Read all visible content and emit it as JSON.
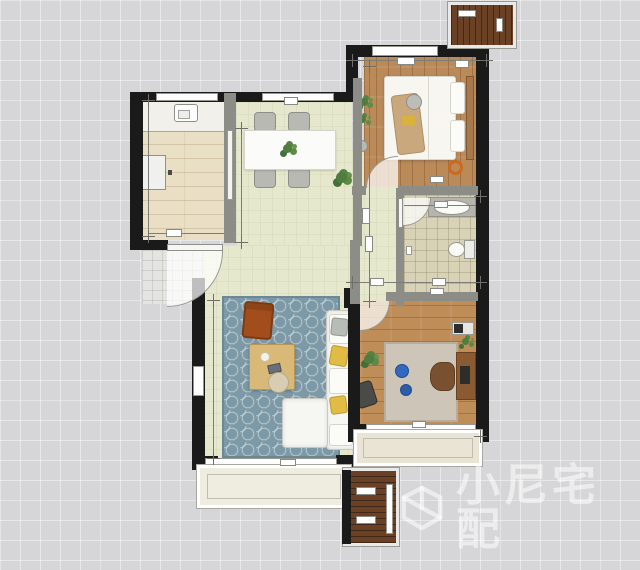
{
  "watermark": {
    "icon": "cube-logo-icon",
    "text": "小尼宅配"
  },
  "palette": {
    "background": "#d6d6d8",
    "grid_line": "#ffffff",
    "wall": "#1a1a1a",
    "partition_wall": "#8d8d88",
    "floor_green": "#e6e8cd",
    "floor_wood": "#bb8a59",
    "floor_kitchen_tile": "#e9dfc5",
    "floor_bath_tile": "#d8d2b7",
    "living_rug_blue": "#7d99a7",
    "bedroom_rug_gray": "#cdc5b7",
    "sofa_white": "#f6f6f3",
    "armchair_orange": "#a14e1c",
    "pillow_yellow": "#e0bc45",
    "coffee_table_wood": "#d9b977",
    "ac_platform_wood": "#6b4126",
    "pouf_blue": "#3069bd",
    "plant_green": "#4f7d3e",
    "watermark_color": "rgba(255,255,255,0.55)"
  },
  "plan": {
    "type": "apartment-floor-plan",
    "rooms": [
      {
        "name": "kitchen"
      },
      {
        "name": "dining-area"
      },
      {
        "name": "master-bedroom"
      },
      {
        "name": "hallway"
      },
      {
        "name": "bathroom"
      },
      {
        "name": "living-room"
      },
      {
        "name": "second-bedroom"
      },
      {
        "name": "entry-lobby"
      },
      {
        "name": "balcony"
      },
      {
        "name": "bay-window"
      },
      {
        "name": "ac-platform-top"
      },
      {
        "name": "ac-platform-bottom"
      }
    ]
  }
}
